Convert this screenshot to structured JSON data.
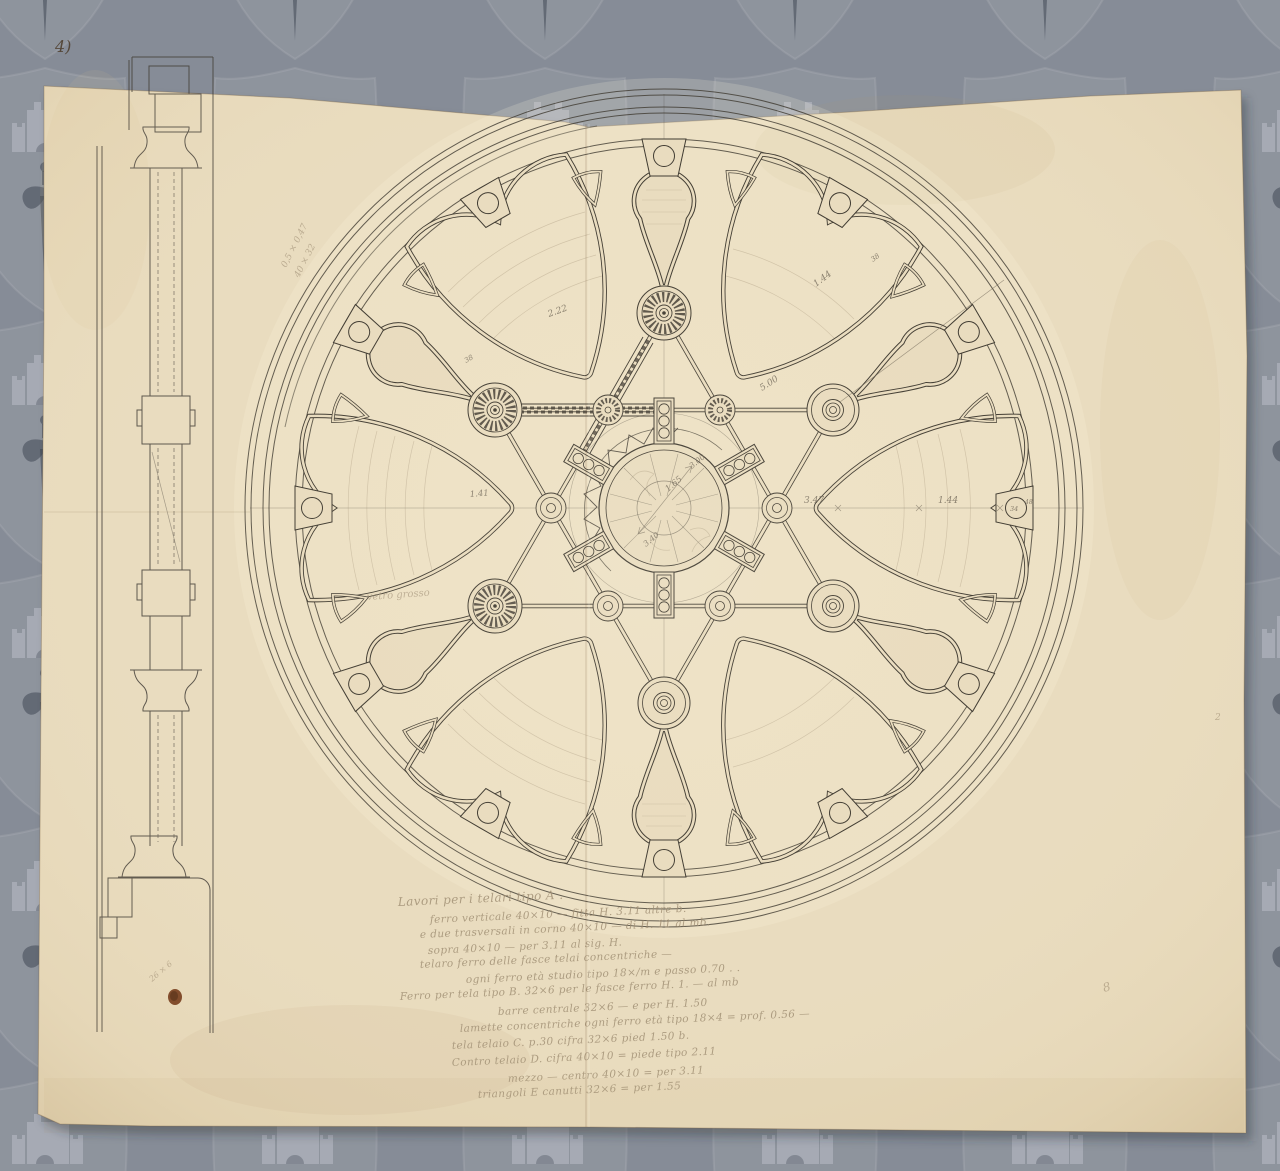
{
  "document": {
    "type": "architectural working drawing: circular rose window plan with mullion section and notes",
    "corner_mark": "4)"
  },
  "watermark": {
    "motifs": [
      "shield",
      "castle-tower",
      "sword-lily"
    ],
    "bg_color": "#8c929d"
  },
  "paper": {
    "color": "#e9dcbf",
    "stain_color": "#7c4526"
  },
  "rose": {
    "note_vetro_grosso": "vetro grosso",
    "dimension_labels": [
      {
        "text": "2.22"
      },
      {
        "text": "1.44"
      },
      {
        "text": "38"
      },
      {
        "text": "5.00"
      },
      {
        "text": "3.47"
      },
      {
        "text": "1.44"
      },
      {
        "text": "34"
      },
      {
        "text": "48"
      },
      {
        "text": "1.65"
      },
      {
        "text": "3.40"
      },
      {
        "text": "3.00"
      },
      {
        "text": "1.41"
      },
      {
        "text": "38"
      }
    ]
  },
  "section": {
    "notes": [
      "0,5 × 0,47",
      "40 × 32"
    ]
  },
  "annotations": {
    "corner_mark": "4)",
    "right_edge_mark": "2",
    "bottom_right_mark": "8",
    "bottom_left_note": "26 × 6",
    "bottom_lines": [
      "Lavori per i telari tipo  A .",
      "ferro verticale 40×10 — fitta H. 3.11 altre b.",
      "e due trasversali in corno 40×10 — di H. 11 al mb.",
      "sopra 40×10 — per 3.11 al sig. H.",
      "telaro ferro delle fasce telai concentriche —",
      "ogni ferro età studio tipo 18×/m e passo 0.70 . .",
      "Ferro per tela tipo B. 32×6 per le fasce ferro H. 1. — al mb",
      "barre centrale 32×6 — e per H. 1.50",
      "lamette concentriche ogni ferro età tipo 18×4 = prof. 0.56 —",
      "tela telaio C. p.30 cifra 32×6 pied 1.50 b.",
      "Contro telaio D. cifra 40×10 = piede tipo 2.11",
      "mezzo — centro 40×10 = per 3.11",
      "triangoli E canutti 32×6 = per 1.55"
    ]
  }
}
